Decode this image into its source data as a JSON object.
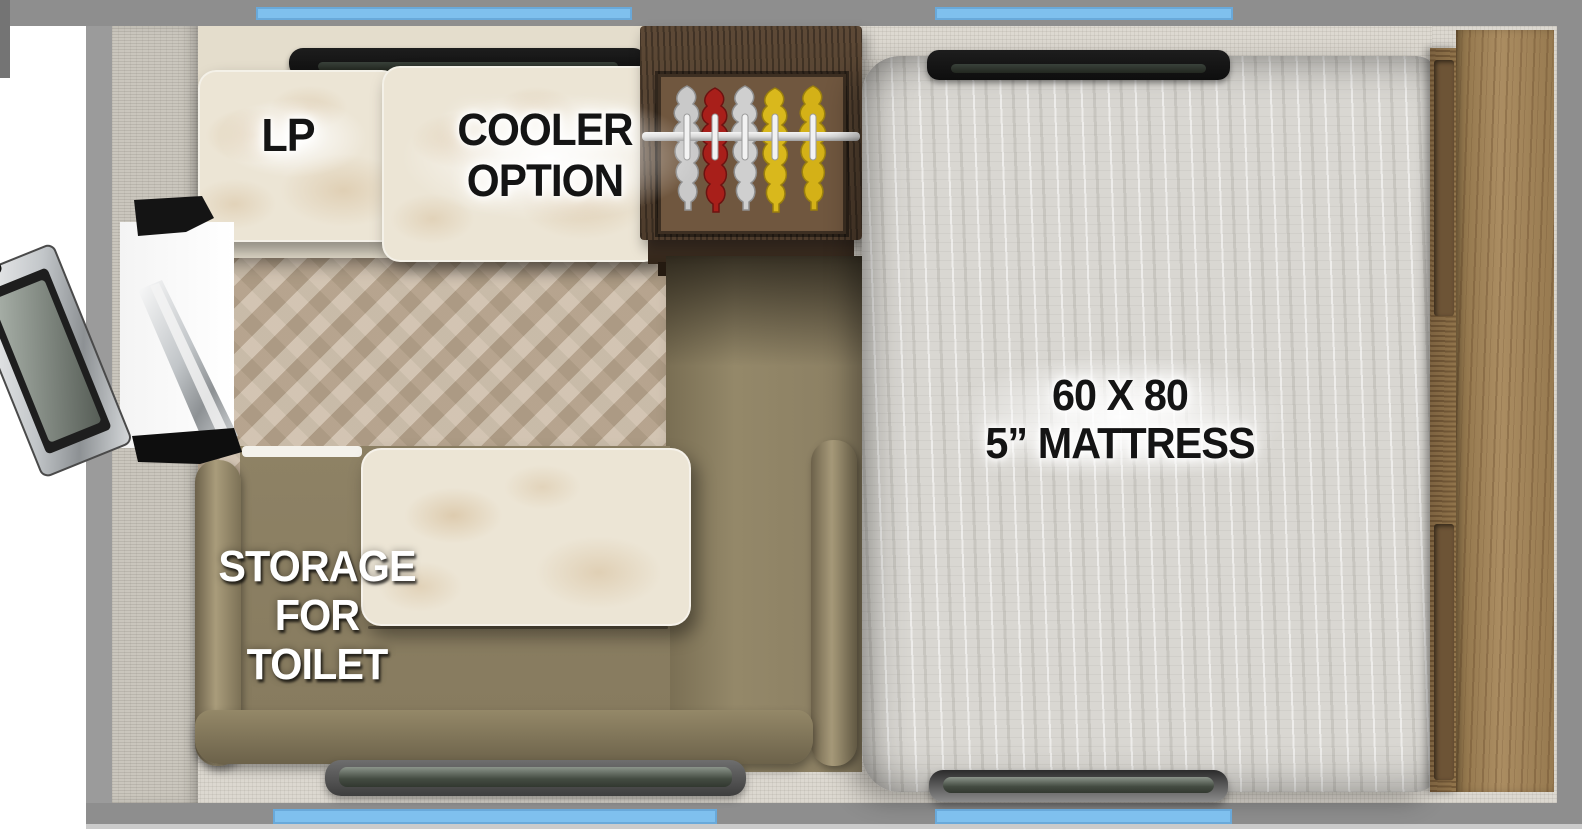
{
  "diagram": {
    "type": "rv-camper-floorplan-top-view",
    "labels": {
      "lp": "LP",
      "cooler_line1": "COOLER",
      "cooler_line2": "OPTION",
      "mattress_line1": "60 X 80",
      "mattress_line2": "5” MATTRESS",
      "storage_line1": "STORAGE",
      "storage_line2": "FOR",
      "storage_line3": "TOILET"
    },
    "features": {
      "windows": [
        "top-left-vent",
        "top-right-window",
        "bottom-center-window",
        "bottom-right-window"
      ],
      "furniture": [
        "lp-compartment",
        "cooler-option-counter",
        "wardrobe-with-hanging-clothes",
        "sofa-with-toilet-storage",
        "dinette-table",
        "queen-mattress",
        "oak-headboard-cabinet",
        "entry-door-open"
      ]
    },
    "colors": {
      "accent_blue": "#7fc0ee",
      "wall_gray": "#8e8e8e",
      "sofa_olive": "#8a7e62",
      "wardrobe_wood": "#5d4936",
      "headboard_oak": "#a18257",
      "mattress_gray": "#d9d7d2",
      "marble_cream": "#ece5d5",
      "clothes_red": "#a81f1a",
      "clothes_yellow": "#d9b81c",
      "clothes_gray": "#c9c9c9"
    }
  }
}
